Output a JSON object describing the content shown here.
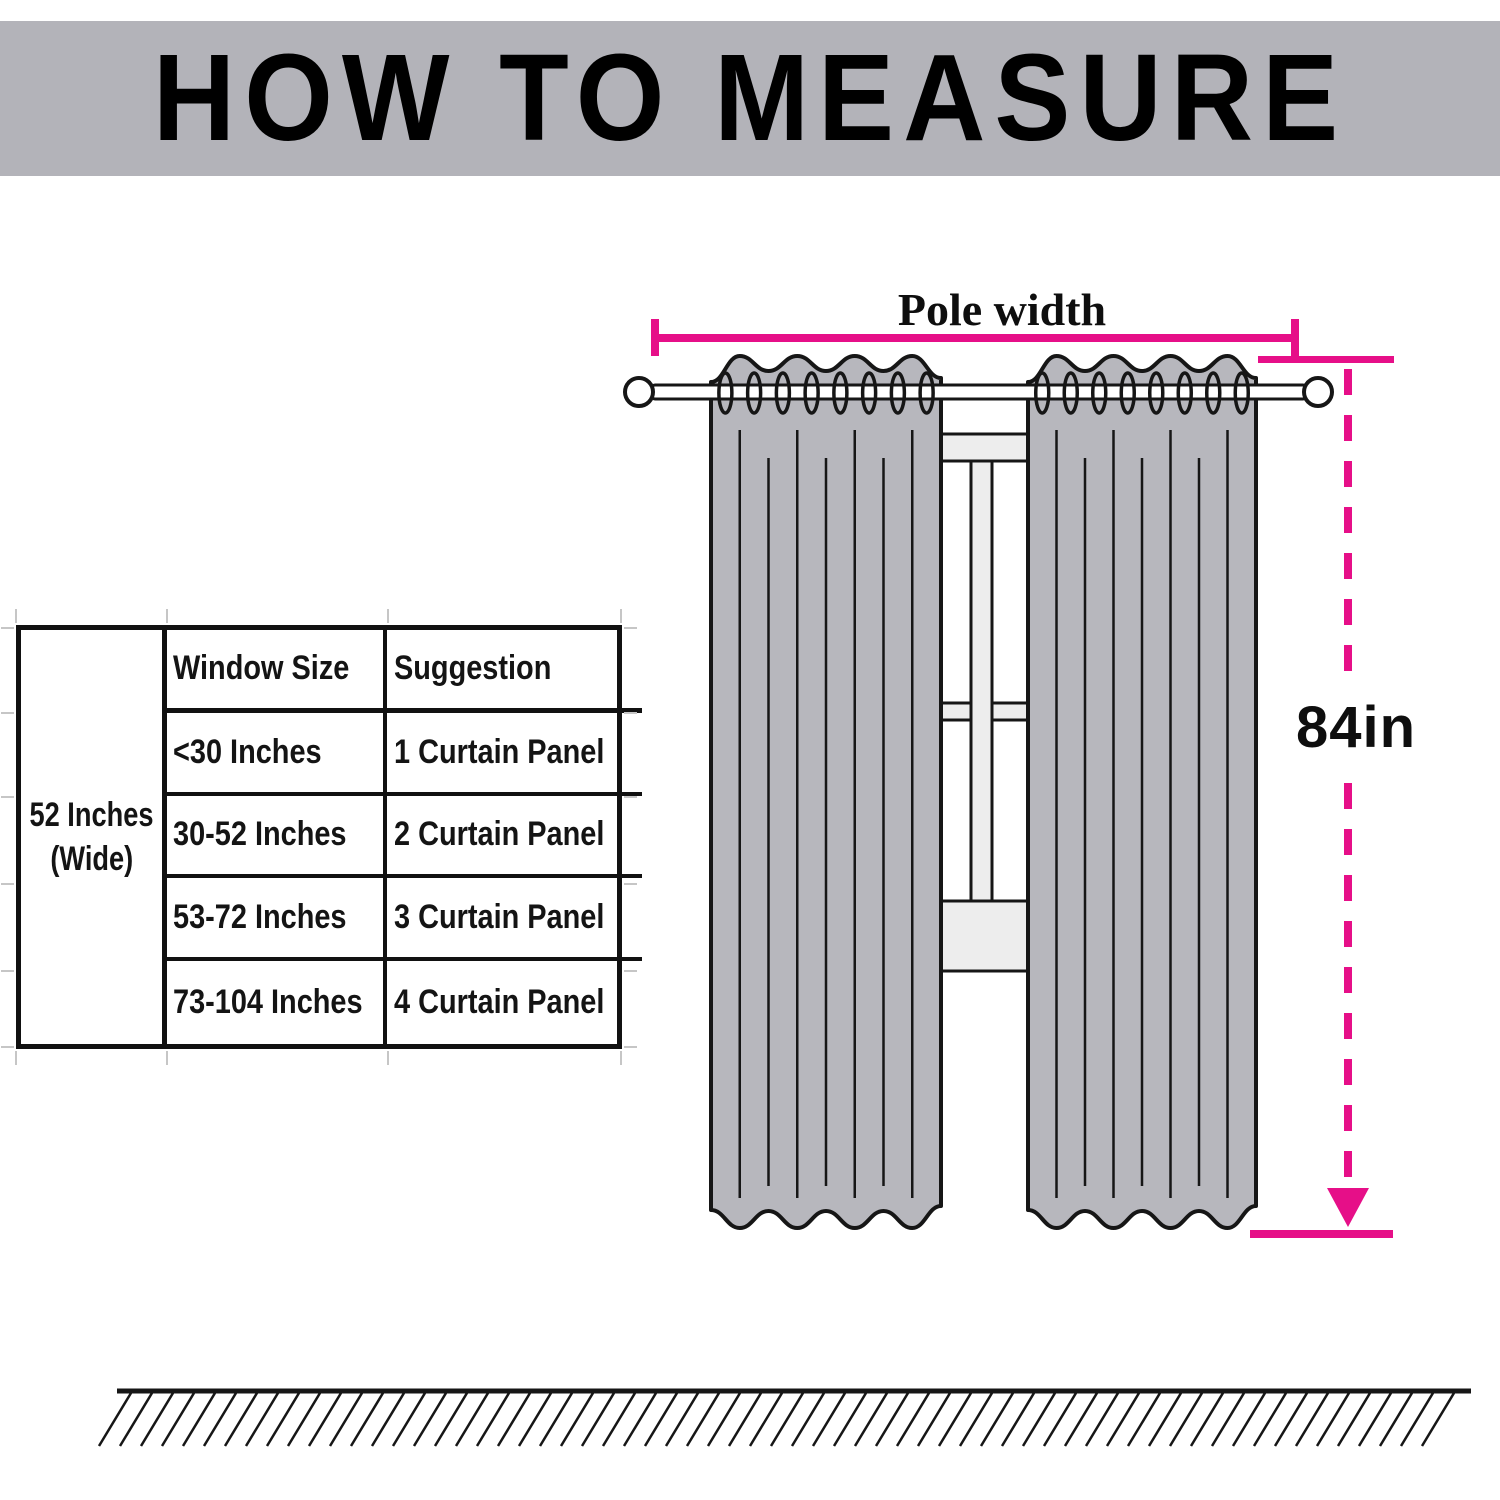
{
  "title": "HOW TO MEASURE",
  "diagram": {
    "pole_width_label": "Pole width",
    "height_label": "84in"
  },
  "table": {
    "merged_cell": {
      "line1": "52 Inches",
      "line2": "(Wide)"
    },
    "headers": [
      "Window Size",
      "Suggestion"
    ],
    "rows": [
      {
        "window_size": "<30 Inches",
        "suggestion": "1 Curtain Panel"
      },
      {
        "window_size": "30-52 Inches",
        "suggestion": "2 Curtain Panel"
      },
      {
        "window_size": "53-72 Inches",
        "suggestion": "3 Curtain Panel"
      },
      {
        "window_size": "73-104 Inches",
        "suggestion": "4 Curtain Panel"
      }
    ]
  },
  "colors": {
    "accent_magenta": "#e60f88",
    "banner_gray": "#b3b3b9",
    "curtain_gray": "#b7b7bd",
    "window_bar_gray": "#ededed",
    "outline_dark": "#161616"
  }
}
